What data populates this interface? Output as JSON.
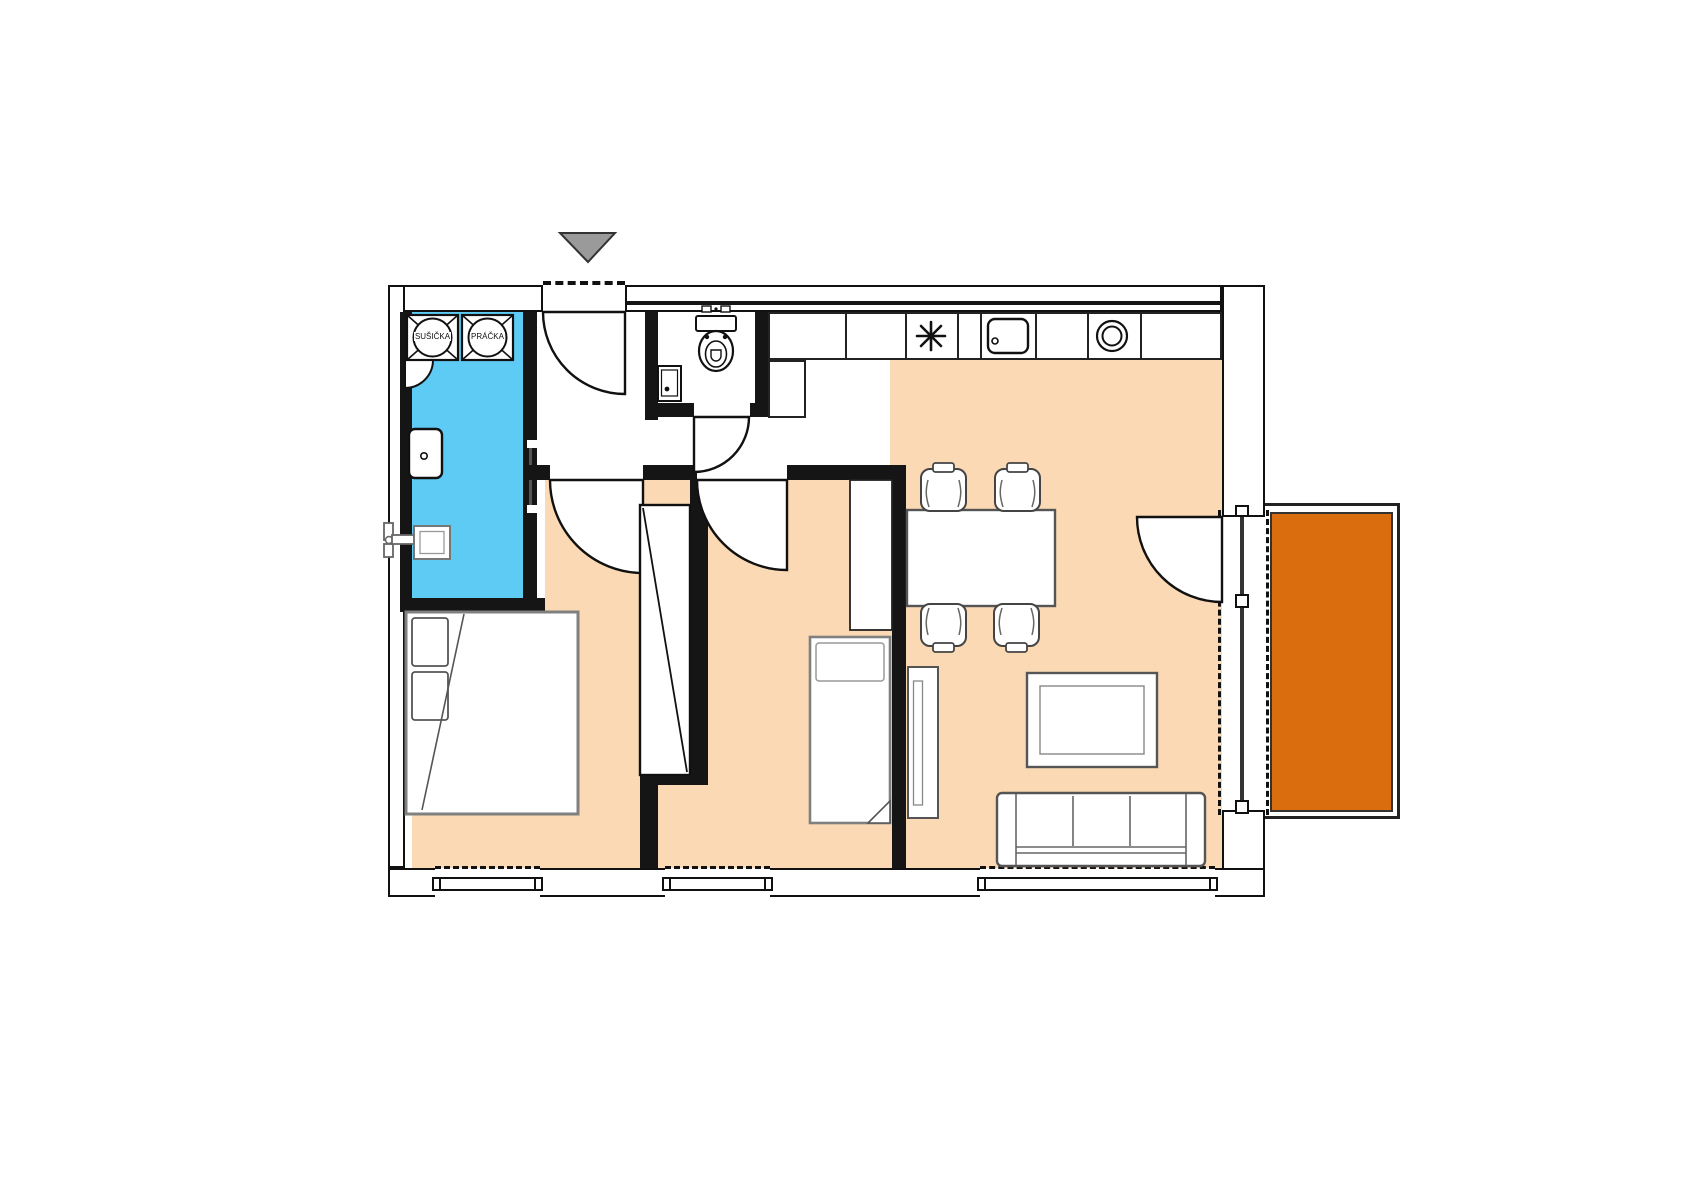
{
  "floor_plan": {
    "type": "apartment-floor-plan",
    "labels": {
      "dryer": "SUŠIČKA",
      "washer": "PRÁČKA"
    },
    "colors": {
      "bathroom_floor": "#5ECBF4",
      "room_floor": "#FBD9B4",
      "balcony_floor": "#DA6E0F",
      "walls": "#151515",
      "entrance_marker": "#9A9A9A",
      "furniture_outline": "#555555"
    },
    "fixtures": [
      "entrance-arrow-icon",
      "door-swing-icon",
      "dryer-icon",
      "washer-icon",
      "washbasin-icon",
      "shower-icon",
      "toilet-icon",
      "small-basin-icon",
      "cooktop-icon",
      "kitchen-sink-icon",
      "round-hob-icon",
      "dining-table-icon",
      "chair-icon",
      "double-bed-icon",
      "single-bed-icon",
      "wardrobe-icon",
      "closet-niche-icon",
      "tv-bench-icon",
      "coffee-table-icon",
      "sofa-icon",
      "window-icon",
      "balcony-railing-icon"
    ]
  }
}
